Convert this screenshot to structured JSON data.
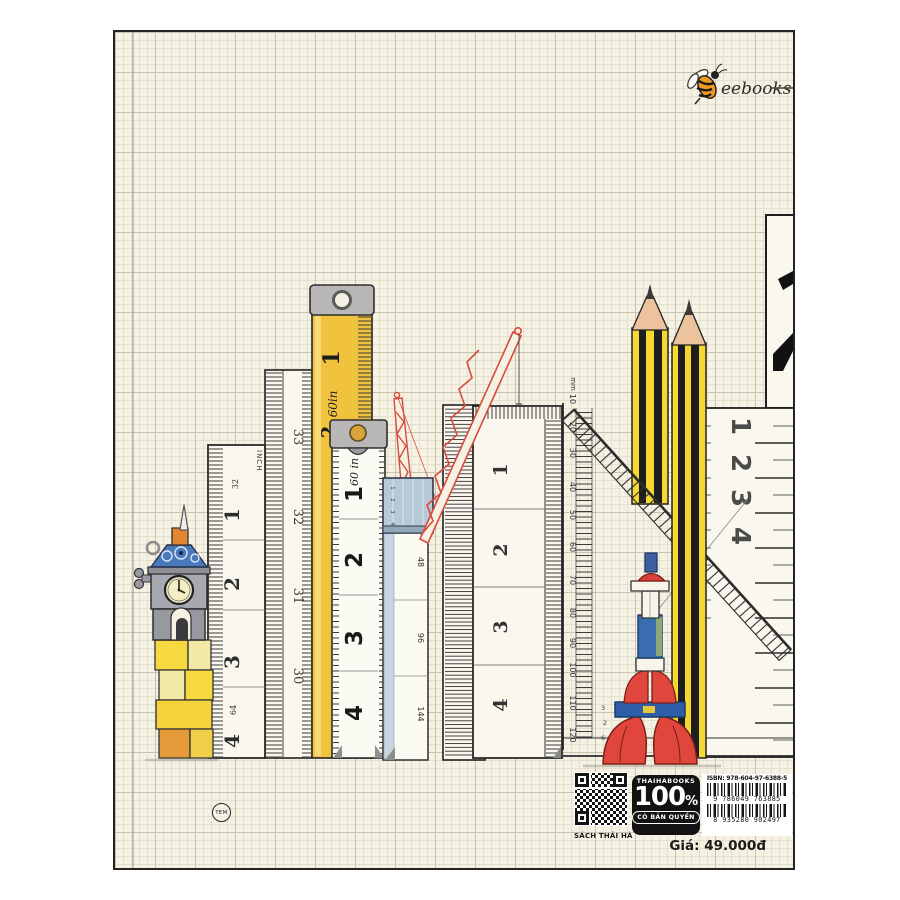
{
  "logo": {
    "brand": "eebooks",
    "icon": "bee-icon"
  },
  "illustration": {
    "ruler_inch": {
      "unit_label": "INCH",
      "half_labels": [
        "32",
        "64"
      ],
      "numbers": [
        "1",
        "2",
        "3",
        "4"
      ]
    },
    "ruler_countdown": {
      "numbers": [
        "33",
        "32",
        "31",
        "30"
      ]
    },
    "tape_yellow": {
      "brand_label": "60in",
      "numbers": [
        "1",
        "2"
      ]
    },
    "tape_white": {
      "brand_label": "60 in",
      "numbers": [
        "1",
        "2",
        "3",
        "4"
      ]
    },
    "ruler_block_blue": {
      "numbers": [
        "1",
        "2",
        "3",
        "4"
      ]
    },
    "ruler_multiples": {
      "numbers": [
        "48",
        "96",
        "144"
      ]
    },
    "ruler_wide": {
      "numbers": [
        "1",
        "2",
        "3",
        "4"
      ]
    },
    "set_square": {
      "unit_label": "mm",
      "scale": [
        "10",
        "20",
        "30",
        "40",
        "50",
        "60",
        "70",
        "80",
        "90",
        "100",
        "110",
        "120"
      ],
      "inner_marks": [
        "3",
        "2",
        "6"
      ]
    },
    "ruler_right": {
      "numbers": [
        "1",
        "2",
        "3",
        "4"
      ]
    }
  },
  "footer": {
    "qr_caption": "SÁCH THÁI HÀ",
    "certification_badge": {
      "publisher": "THAIHABOOKS",
      "percent_value": "100",
      "percent_sign": "%",
      "tagline": "CÓ BẢN QUYỀN"
    },
    "barcode": {
      "isbn_label": "ISBN: 978-604-97-6388-5",
      "ean13_digits": "9 786049 763885",
      "ean13_digits_2": "8 935280 902497"
    },
    "price_label": "Giá: 49.000đ",
    "stamp_label": "TEM"
  },
  "colors": {
    "paper": "#f5f2e3",
    "tape_yellow": "#f0c23e",
    "pencil_yellow": "#f5d832",
    "accent_red": "#df463c",
    "accent_blue": "#3a6cb0",
    "metal_gray": "#b9b6b8"
  }
}
